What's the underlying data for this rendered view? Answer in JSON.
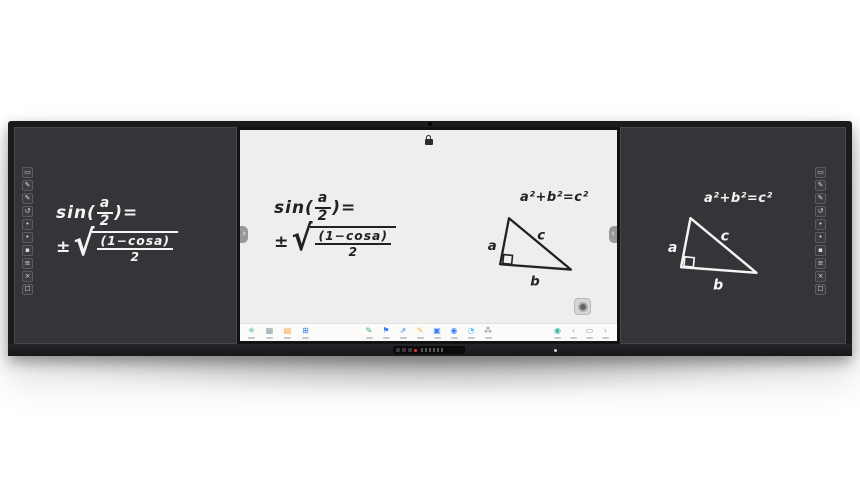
{
  "device": {
    "type": "tri-panel smart blackboard"
  },
  "formulas": {
    "half_angle": {
      "prefix": "sin(",
      "num": "a",
      "den": "2",
      "close": ")=",
      "pm": "±",
      "rad_sign": "√",
      "rad_num": "(1−cosa)",
      "rad_den": "2"
    },
    "pythagorean": "a²+b²=c²",
    "triangle": {
      "side_a": "a",
      "hyp": "c",
      "side_b": "b"
    }
  },
  "screen": {
    "tabs": {
      "left_glyph": "›",
      "right_glyph": "‹"
    }
  },
  "side_toolbar": {
    "icons": [
      {
        "name": "board-icon",
        "glyph": "▭"
      },
      {
        "name": "pen-icon",
        "glyph": "✎"
      },
      {
        "name": "marker-icon",
        "glyph": "✎"
      },
      {
        "name": "history-icon",
        "glyph": "↺"
      },
      {
        "name": "shape-icon",
        "glyph": "•"
      },
      {
        "name": "sticker-icon",
        "glyph": "•"
      },
      {
        "name": "eraser-icon",
        "glyph": "▪"
      },
      {
        "name": "layers-icon",
        "glyph": "≡"
      },
      {
        "name": "clear-icon",
        "glyph": "×"
      },
      {
        "name": "select-icon",
        "glyph": "☐"
      }
    ]
  },
  "taskbar": {
    "left": [
      {
        "name": "settings-icon",
        "glyph": "✳",
        "color": "#35b8a5"
      },
      {
        "name": "apps-grid-icon",
        "glyph": "▦",
        "color": "#8f9aa6"
      },
      {
        "name": "files-icon",
        "glyph": "▤",
        "color": "#f2a33c"
      },
      {
        "name": "windows-icon",
        "glyph": "⊞",
        "color": "#2e7ce0"
      }
    ],
    "center": [
      {
        "name": "annotate-icon",
        "glyph": "✎",
        "color": "#2fae6e"
      },
      {
        "name": "courseware-icon",
        "glyph": "⚑",
        "color": "#3b82f6"
      },
      {
        "name": "share-screen-icon",
        "glyph": "⇗",
        "color": "#3b82f6"
      },
      {
        "name": "highlighter-icon",
        "glyph": "✎",
        "color": "#f5b93c"
      },
      {
        "name": "display-icon",
        "glyph": "▣",
        "color": "#3b82f6"
      },
      {
        "name": "tools-icon",
        "glyph": "◉",
        "color": "#3b82f6"
      },
      {
        "name": "timer-icon",
        "glyph": "◔",
        "color": "#4fc3f7"
      },
      {
        "name": "mindmap-icon",
        "glyph": "⁂",
        "color": "#7b8794"
      }
    ],
    "right": [
      {
        "name": "record-icon",
        "glyph": "◉",
        "color": "#35b8a5"
      },
      {
        "name": "back-icon",
        "glyph": "‹",
        "color": "#9aa0a6"
      },
      {
        "name": "home-icon",
        "glyph": "▭",
        "color": "#9aa0a6"
      },
      {
        "name": "forward-icon",
        "glyph": "›",
        "color": "#9aa0a6"
      }
    ]
  },
  "colors": {
    "board_surface": "#333538",
    "display_surface": "#efeeec",
    "frame": "#1b1b1d",
    "record_led": "#e23b2e"
  }
}
